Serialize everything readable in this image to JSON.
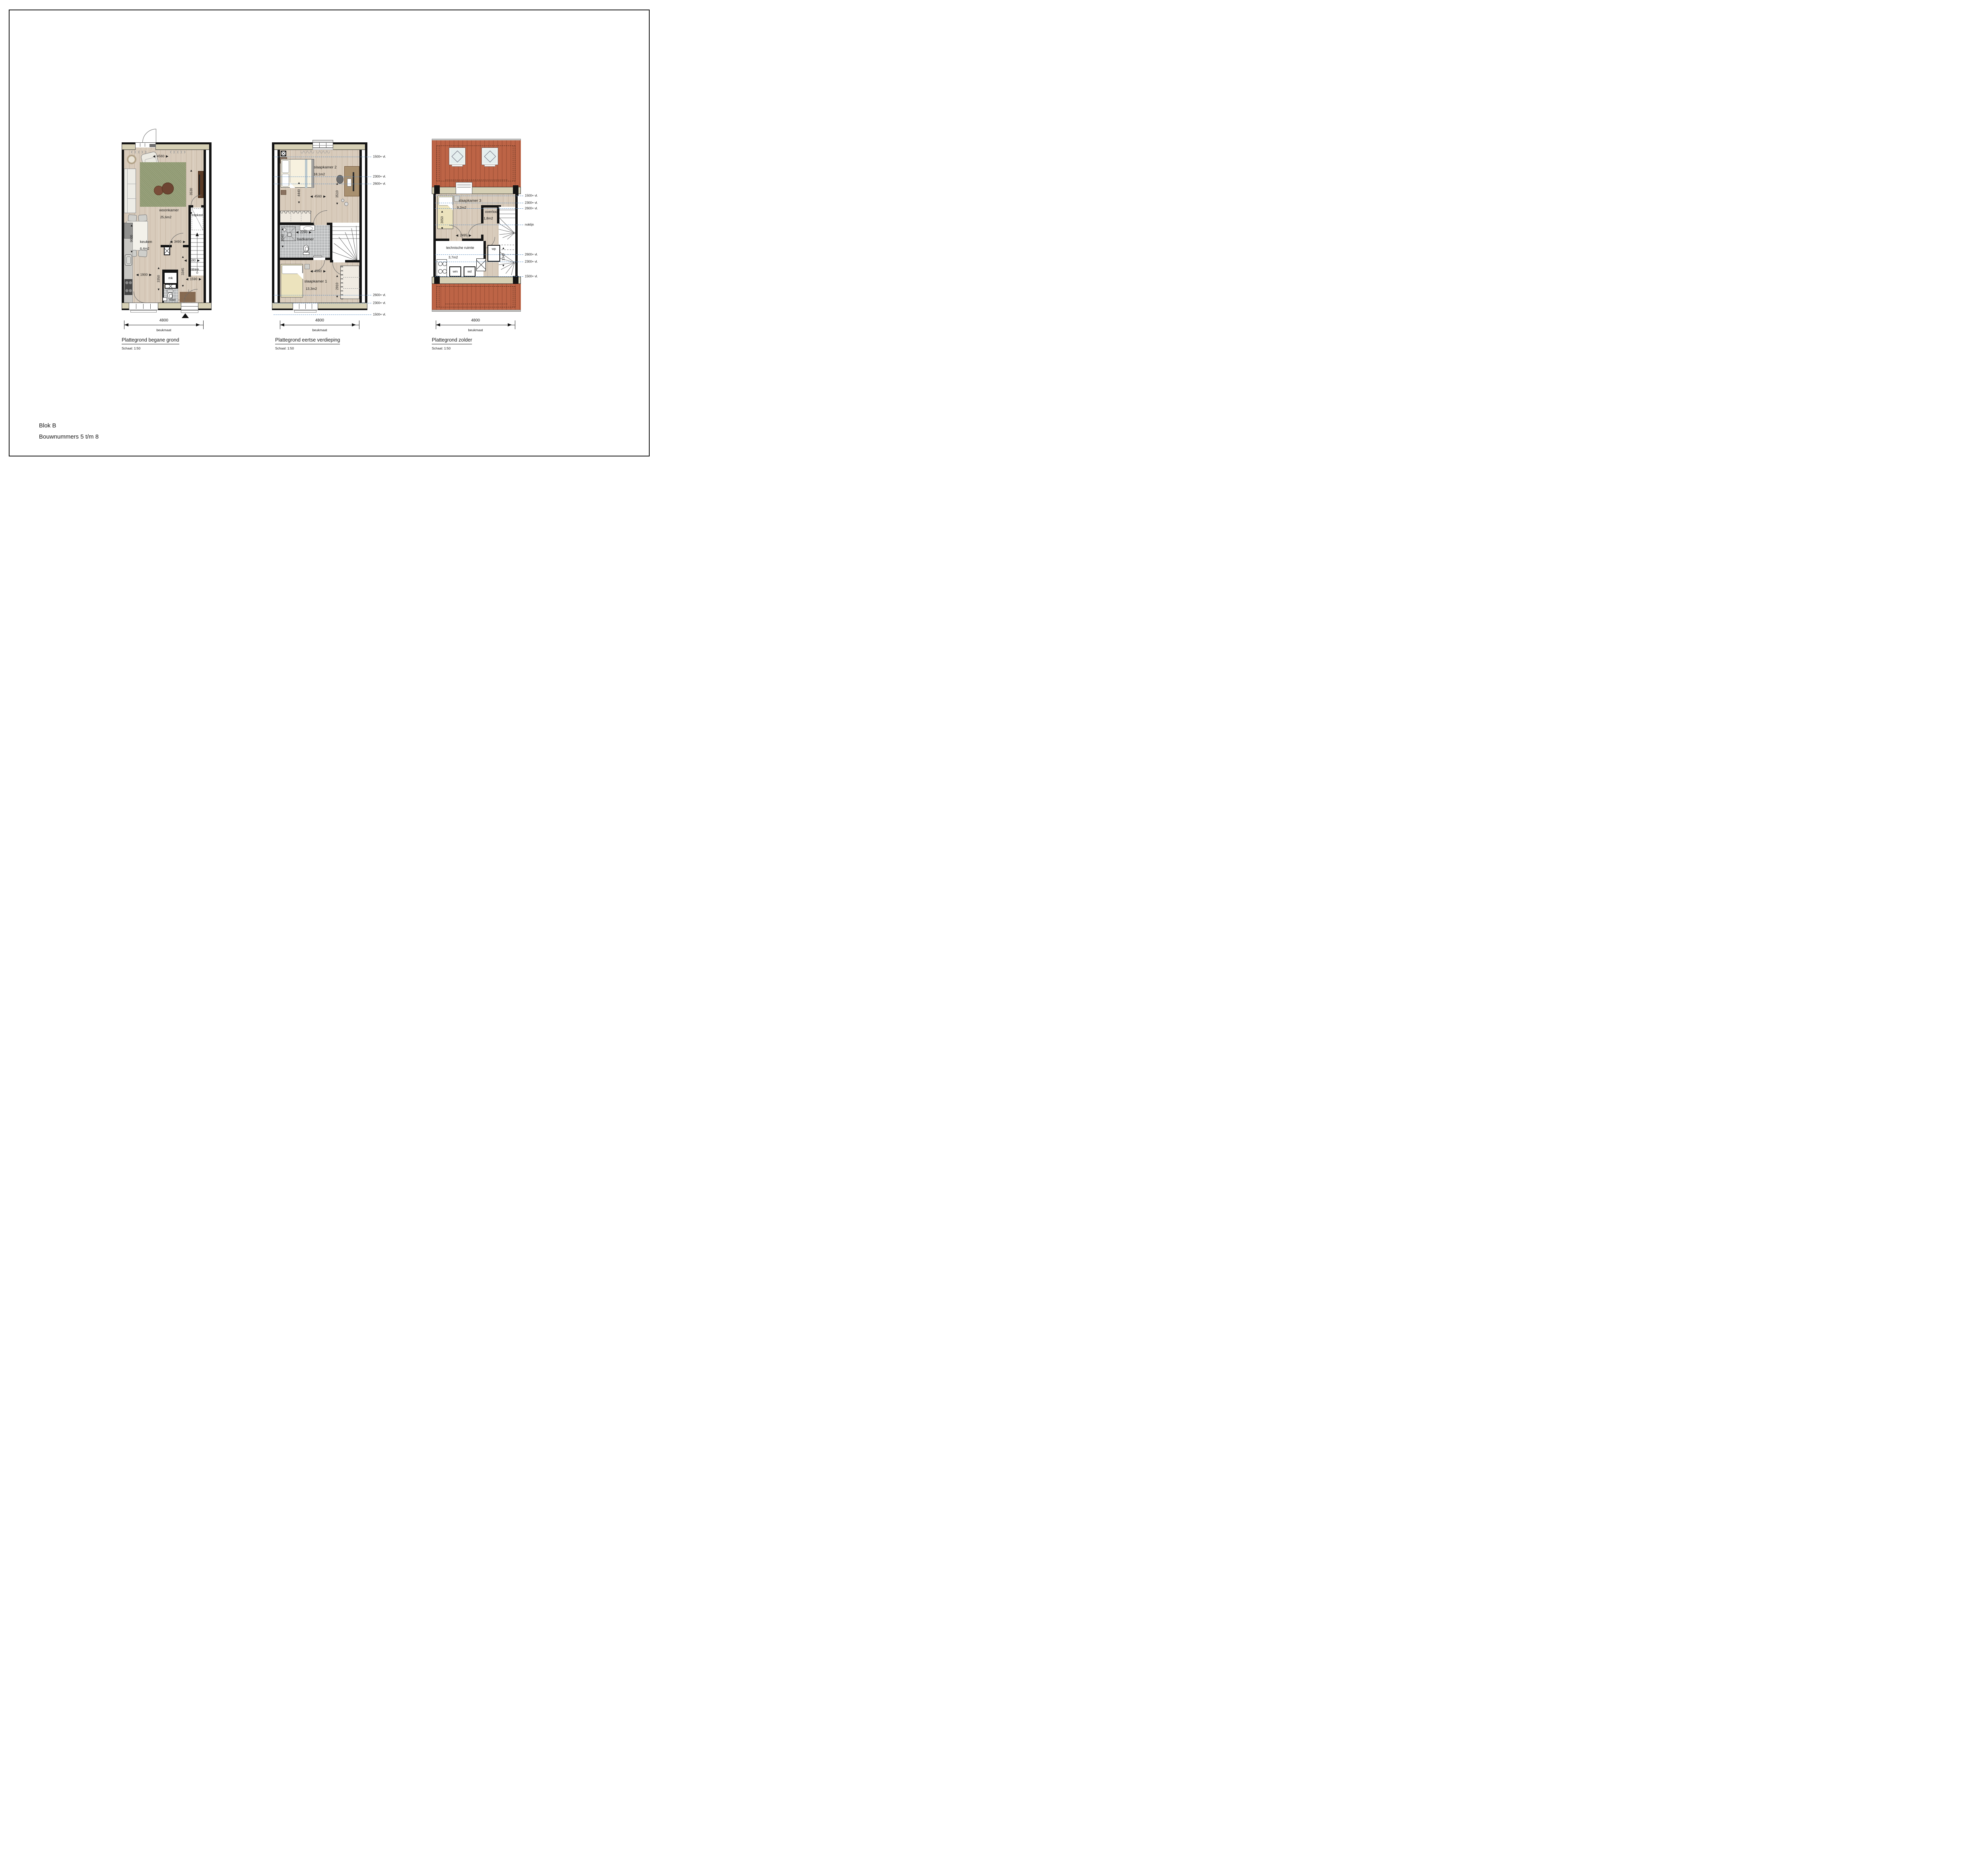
{
  "document": {
    "footer_line1": "Blok B",
    "footer_line2": "Bouwnummers 5 t/m 8"
  },
  "shared": {
    "beam_width": "4800",
    "beam_label": "beukmaat",
    "scale_label": "Schaal: 1:50"
  },
  "ui": {
    "al": "◀",
    "ar": "▶",
    "au": "▲",
    "ad": "▼"
  },
  "colors": {
    "facade_band": "#d6d0b5",
    "roof": "#bd6446",
    "floor_wood": "#d8cbbb",
    "rug_green": "#8e9870",
    "level_line_blue": "#5d8ec2",
    "wall_black": "#141414"
  },
  "plans": {
    "ground": {
      "title": "Plattegrond begane grond",
      "rooms": {
        "living": "woonkamer",
        "living_area": "25,6m2",
        "kitchen": "keuken",
        "kitchen_area": "6,4m2",
        "closet": "trapkast",
        "entry": "entree",
        "toilet": "toilet",
        "meter": "mk"
      },
      "dims": {
        "w4560": "4560",
        "h3530": "3530",
        "h9600": "9600",
        "w3490": "3490",
        "w1900": "1900",
        "h3350": "3350",
        "w2590": "2590",
        "h3345": "3345",
        "w1590": "1590"
      }
    },
    "first": {
      "title": "Plattegrond eertse verdieping",
      "rooms": {
        "bedroom2": "slaapkamer 2",
        "bedroom2_area": "18,1m2",
        "bathroom": "badkamer",
        "bedroom1": "slaapkamer 1",
        "bedroom1_area": "13,3m2"
      },
      "dims": {
        "h4440": "4440",
        "w4560": "4560",
        "h3510": "3510",
        "w2290": "2290",
        "h2040": "2040",
        "w4560b": "4560",
        "h2910": "2910"
      },
      "levels_top": [
        "1500+ vl.",
        "2300+ vl.",
        "2600+ vl."
      ],
      "levels_bottom": [
        "2600+ vl.",
        "2300+ vl.",
        "1500+ vl."
      ]
    },
    "attic": {
      "title": "Plattegrond zolder",
      "rooms": {
        "bedroom3": "slaapkamer 3",
        "bedroom3_area": "9,2m2",
        "landing": "overloop",
        "landing_area": "1,8m2",
        "tech": "technische ruimte",
        "tech_area": "3,7m2",
        "wm": "wm",
        "wd": "wd",
        "wp": "wp"
      },
      "dims": {
        "h3050": "3050",
        "w2495": "2495",
        "h1340": "1340"
      },
      "levels_top": [
        "1500+ vl.",
        "2300+ vl.",
        "2600+ vl."
      ],
      "ridge": "noklijn",
      "levels_bottom": [
        "2600+ vl.",
        "2300+ vl.",
        "1500+ vl."
      ]
    }
  }
}
